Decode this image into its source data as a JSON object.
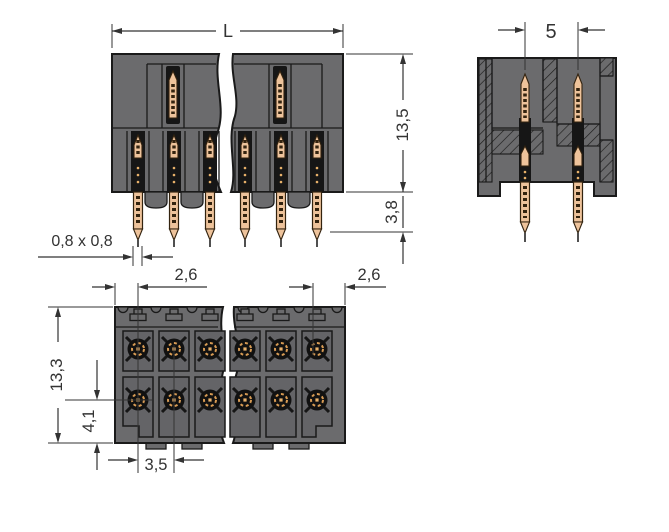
{
  "drawing": {
    "background": "#ffffff",
    "colors": {
      "housing": "#6b6b6d",
      "cell": "#646467",
      "cavity": "#161616",
      "pin": "#eec39b",
      "pin_outline": "#33230f",
      "outline": "#1a1a1a",
      "dimension": "#333333"
    },
    "views": {
      "front": {
        "name": "front-elevation",
        "dims": {
          "overall_width": "L",
          "housing_height": "13,5",
          "pin_tip_offset": "3,8",
          "pin_cross_section": "0,8 x 0,8"
        }
      },
      "section": {
        "name": "side-cross-section",
        "dims": {
          "row_pitch": "5"
        }
      },
      "bottom": {
        "name": "underside-view",
        "dims": {
          "edge_to_first_pin": "2,6",
          "last_pin_to_edge": "2,6",
          "housing_depth": "13,3",
          "row_to_edge": "4,1",
          "pin_pitch": "3,5"
        }
      }
    }
  }
}
